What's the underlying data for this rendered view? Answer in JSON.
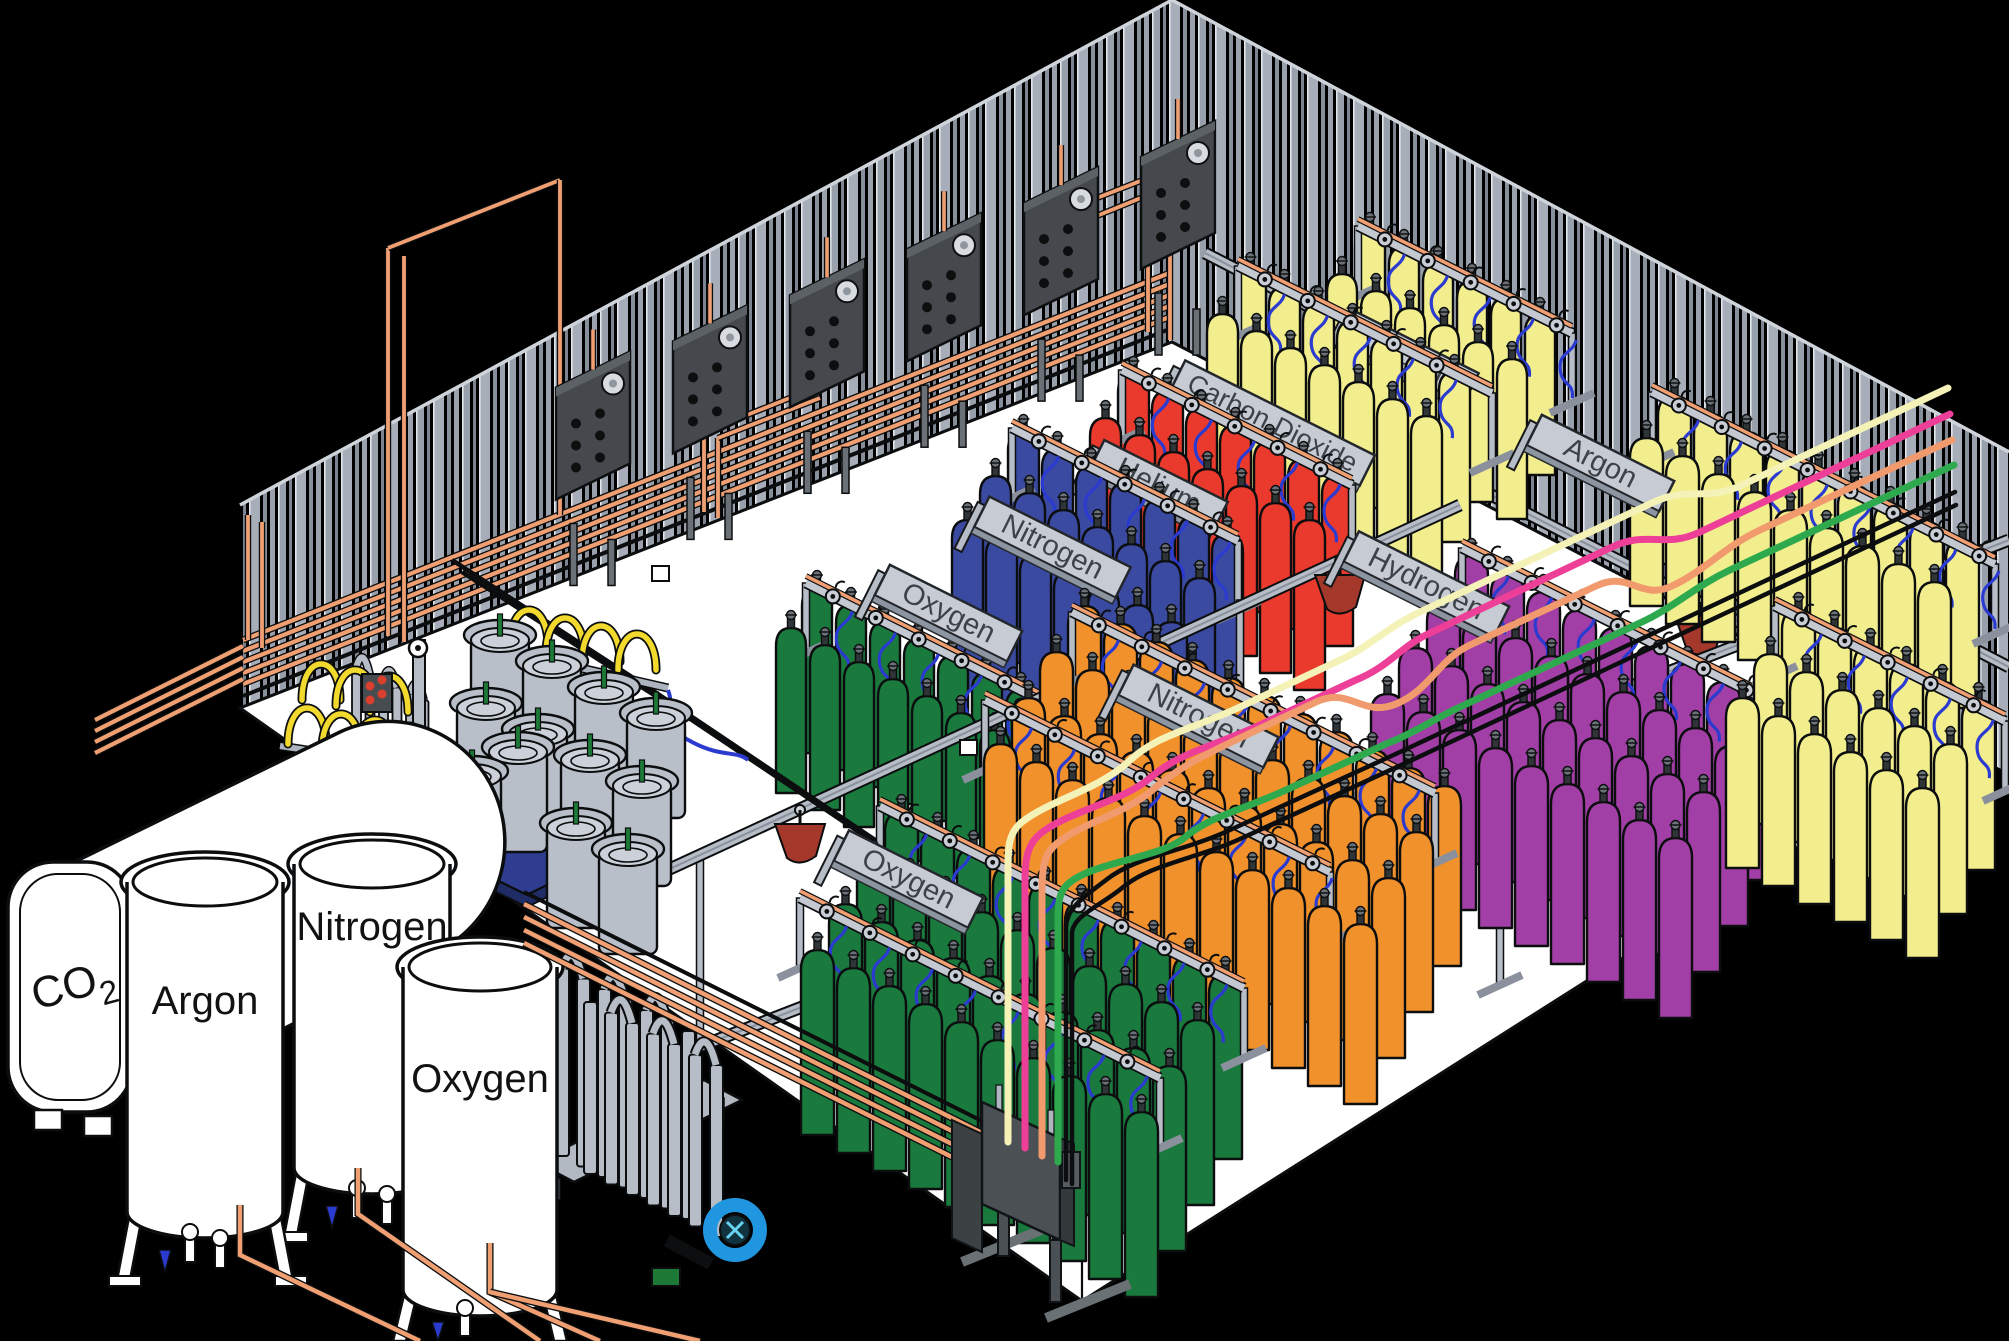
{
  "diagram": {
    "description": "Isometric cutaway illustration of an industrial gas filling plant: bulk cryogenic tanks outside, dewars, vaporizer tube racks, manifold rows of colored gas cylinders with labeled signs, overhead hoist rails and colored transfer lines."
  },
  "bulk_tanks": {
    "co2": {
      "label": "CO",
      "subscript": "2"
    },
    "argon": {
      "label": "Argon"
    },
    "nitrogen": {
      "label": "Nitrogen"
    },
    "oxygen": {
      "label": "Oxygen"
    }
  },
  "manifold_signs": {
    "oxygen_back": "Oxygen",
    "nitrogen_back": "Nitrogen",
    "helium": "Helium",
    "carbon_dioxide": "Carbon Dioxide",
    "argon_back": "Argon",
    "argon_right": "Argon",
    "hydrogen": "Hydrogen",
    "nitrogen_front": "Nitrogen",
    "oxygen_front": "Oxygen"
  },
  "cylinder_colors": {
    "oxygen": "#1a7a3e",
    "nitrogen_high_pressure": "#3b4aa1",
    "helium": "#ea3a2d",
    "carbon_dioxide": "#f2ee8e",
    "argon": "#f2ee8e",
    "hydrogen": "#a23fa6",
    "nitrogen_bulk": "#f0912c",
    "dewar_gray": "#b9bfc9"
  },
  "accent_colors": {
    "copper_pipe": "#ef9f72",
    "hose_blue": "#2b3bd0",
    "trolley_red": "#a4382b",
    "pallet_blue": "#2e3d8f",
    "turbine_blue": "#2196e0",
    "line_cream": "#f5f2b8",
    "line_pink": "#ee3f98",
    "line_salmon": "#f19a6e",
    "line_green": "#2fa94e",
    "sign_gray": "#c6cbd4",
    "floor_white": "#ffffff",
    "wall_stripe_gray": "#9ba3af"
  }
}
